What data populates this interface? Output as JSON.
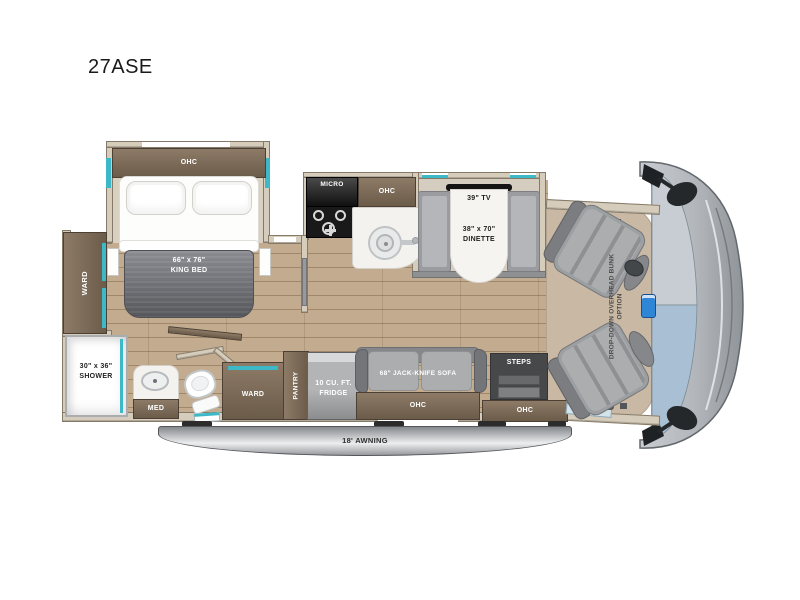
{
  "page": {
    "title": "27ASE"
  },
  "colors": {
    "accent_teal": "#3cb8c6",
    "floor_wood": "#b59c7e",
    "cabinet_brown": "#7a6a58",
    "windshield_blue": "#a9c0d4",
    "awning_gray": "#c7c9cc"
  },
  "floorplan": {
    "bedroom": {
      "slide_ohc": "OHC",
      "bed_size": "66\" x 76\"",
      "bed_type": "KING BED",
      "ward": "WARD"
    },
    "bath": {
      "shower_size": "30\" x 36\"",
      "shower": "SHOWER",
      "med": "MED"
    },
    "galley": {
      "micro": "MICRO",
      "ohc": "OHC"
    },
    "storage": {
      "ward": "WARD",
      "pantry": "PANTRY",
      "fridge_line1": "10 CU. FT.",
      "fridge_line2": "FRIDGE"
    },
    "dinette": {
      "tv": "39\" TV",
      "size": "38\" x 70\"",
      "name": "DINETTE"
    },
    "living": {
      "sofa": "68\" JACK-KNIFE SOFA",
      "sofa_ohc": "OHC",
      "steps": "STEPS",
      "entry_ohc": "OHC"
    },
    "cab": {
      "bunk_option": "DROP-DOWN OVERHEAD BUNK OPTION"
    },
    "exterior": {
      "awning": "18' AWNING"
    }
  }
}
